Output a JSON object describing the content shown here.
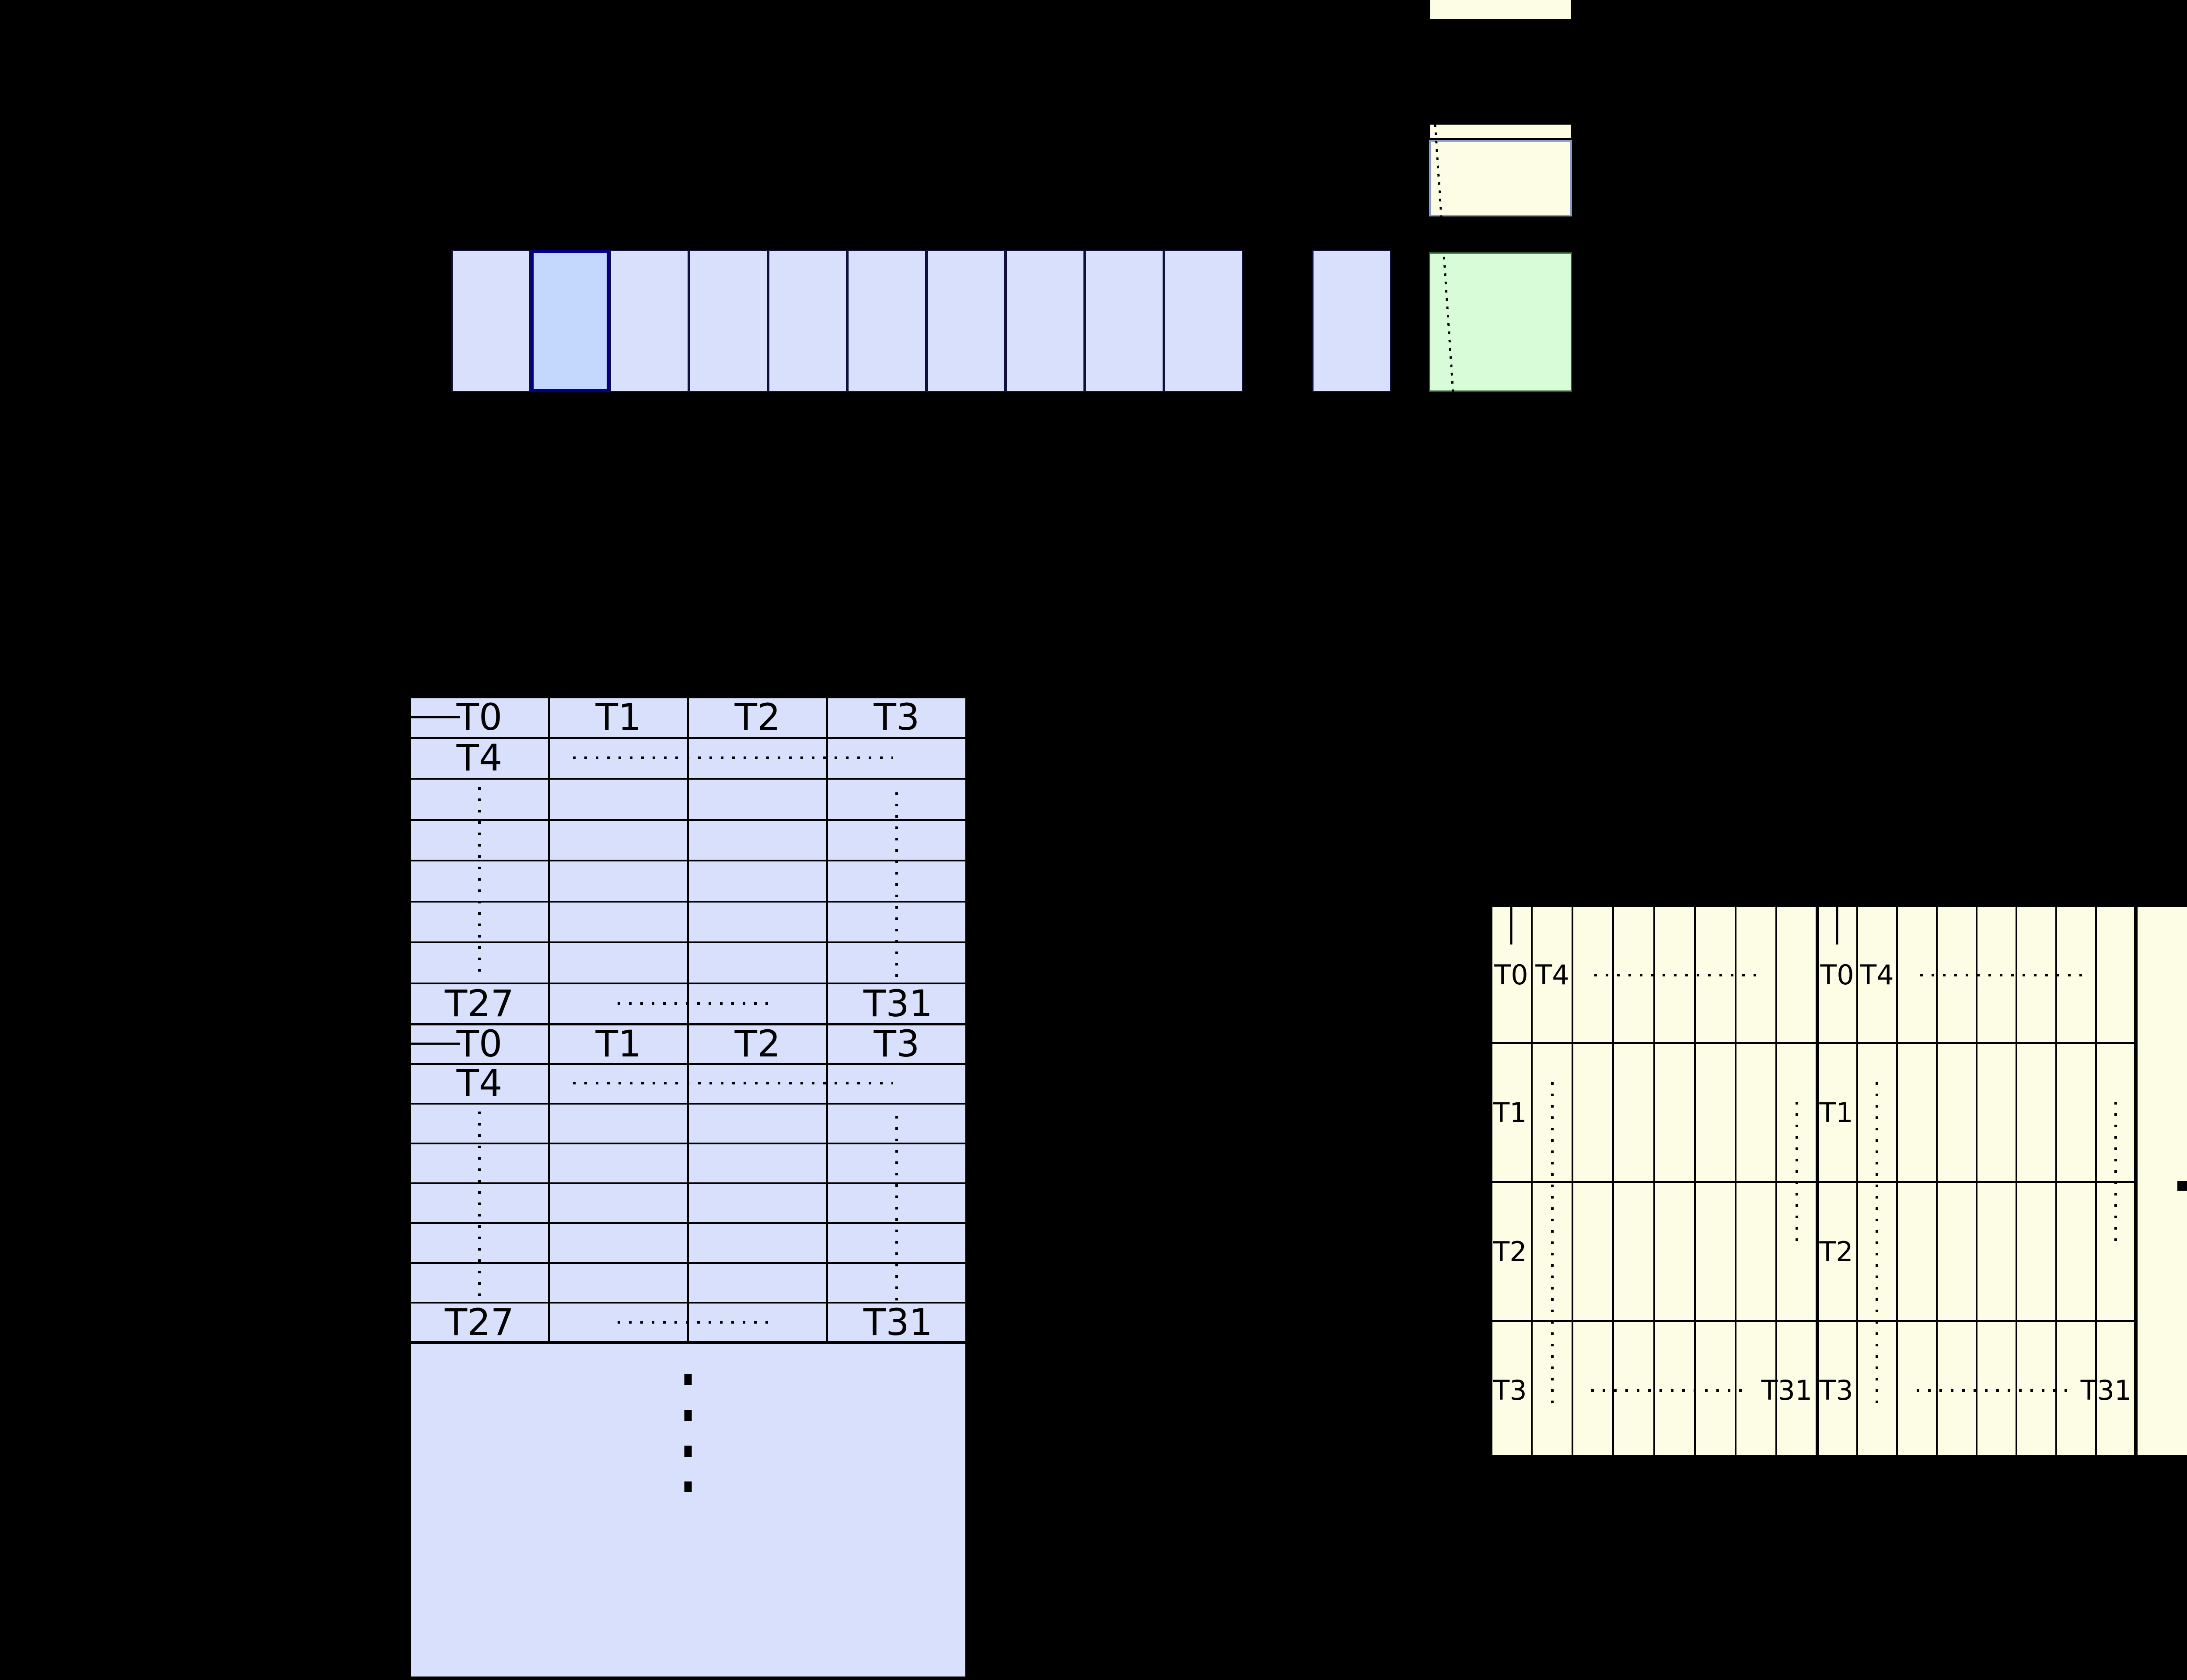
{
  "diagram": {
    "background": "#000000",
    "palette": {
      "cell_fill": "#d8e0fc",
      "cell_border": "#10103a",
      "highlight_fill": "#c3d8fc",
      "highlight_border": "#00008b",
      "yellow_fill": "#fdfce4",
      "slate_border": "#8a9ac8",
      "green_fill": "#d8fbd8",
      "green_border": "#2e5e2e",
      "line_color": "#000000"
    },
    "warp_row": {
      "cell_count": 10,
      "highlighted_index": 1,
      "detached_cell_count": 1
    },
    "left_table": {
      "blocks": [
        {
          "header": [
            "T0",
            "T1",
            "T2",
            "T3"
          ],
          "row2": "T4",
          "bottom_left": "T27",
          "bottom_right": "T31"
        },
        {
          "header": [
            "T0",
            "T1",
            "T2",
            "T3"
          ],
          "row2": "T4",
          "bottom_left": "T27",
          "bottom_right": "T31"
        }
      ]
    },
    "right_table": {
      "blocks": [
        {
          "top_row": [
            "T0",
            "T4"
          ],
          "side_rows": [
            "T1",
            "T2",
            "T3"
          ],
          "bottom_right": "T31"
        },
        {
          "top_row": [
            "T0",
            "T4"
          ],
          "side_rows": [
            "T1",
            "T2",
            "T3"
          ],
          "bottom_right": "T31"
        }
      ]
    }
  }
}
